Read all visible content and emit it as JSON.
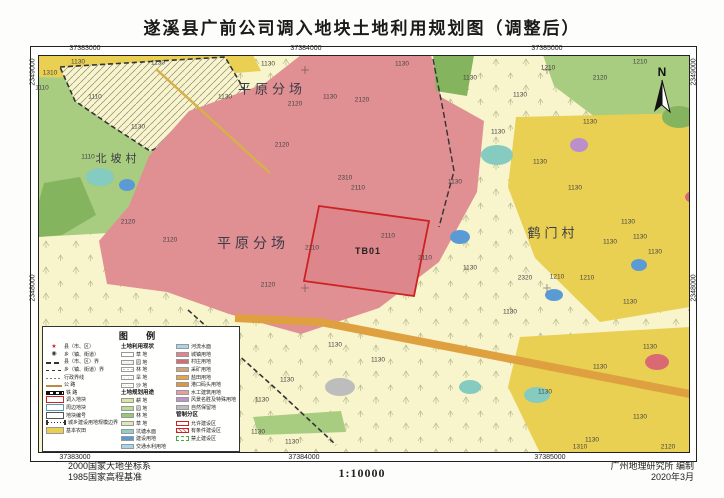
{
  "title": "遂溪县广前公司调入地块土地利用规划图（调整后）",
  "north": {
    "label": "N"
  },
  "footer": {
    "datum1": "2000国家大地坐标系",
    "datum2": "1985国家高程基准",
    "scale": "1:10000",
    "credit1": "广州地理研究所 编制",
    "credit2": "2020年3月"
  },
  "coords": {
    "top": [
      {
        "t": "37383000",
        "x": 85
      },
      {
        "t": "37384000",
        "x": 306
      },
      {
        "t": "37385000",
        "x": 547
      }
    ],
    "bottom": [
      {
        "t": "37383000",
        "x": 75
      },
      {
        "t": "37384000",
        "x": 304
      },
      {
        "t": "37385000",
        "x": 550
      }
    ],
    "left": [
      {
        "t": "2349000",
        "y": 72
      },
      {
        "t": "2348000",
        "y": 288
      }
    ],
    "right": [
      {
        "t": "2349000",
        "y": 72
      },
      {
        "t": "2348000",
        "y": 288
      }
    ]
  },
  "places": [
    {
      "t": "平原分场",
      "x": 272,
      "y": 88,
      "s": 13
    },
    {
      "t": "北坡村",
      "x": 118,
      "y": 158,
      "s": 11
    },
    {
      "t": "平原分场",
      "x": 253,
      "y": 243,
      "s": 14
    },
    {
      "t": "鹤门村",
      "x": 553,
      "y": 232,
      "s": 13
    },
    {
      "t": "TB01",
      "x": 368,
      "y": 251,
      "s": 9,
      "b": 1
    }
  ],
  "codes": [
    {
      "t": "1130",
      "x": 78,
      "y": 62
    },
    {
      "t": "1130",
      "x": 158,
      "y": 63
    },
    {
      "t": "1130",
      "x": 268,
      "y": 64
    },
    {
      "t": "1130",
      "x": 402,
      "y": 64
    },
    {
      "t": "1210",
      "x": 548,
      "y": 68
    },
    {
      "t": "1210",
      "x": 640,
      "y": 62
    },
    {
      "t": "1310",
      "x": 50,
      "y": 73
    },
    {
      "t": "1110",
      "x": 42,
      "y": 88
    },
    {
      "t": "1110",
      "x": 95,
      "y": 97
    },
    {
      "t": "1130",
      "x": 225,
      "y": 97
    },
    {
      "t": "1130",
      "x": 330,
      "y": 97
    },
    {
      "t": "2120",
      "x": 295,
      "y": 104
    },
    {
      "t": "2120",
      "x": 362,
      "y": 100
    },
    {
      "t": "1130",
      "x": 138,
      "y": 127
    },
    {
      "t": "1110",
      "x": 88,
      "y": 157
    },
    {
      "t": "2120",
      "x": 282,
      "y": 145
    },
    {
      "t": "2310",
      "x": 345,
      "y": 178
    },
    {
      "t": "2110",
      "x": 358,
      "y": 188
    },
    {
      "t": "2120",
      "x": 128,
      "y": 222
    },
    {
      "t": "2120",
      "x": 170,
      "y": 240
    },
    {
      "t": "2110",
      "x": 312,
      "y": 248
    },
    {
      "t": "2110",
      "x": 388,
      "y": 236
    },
    {
      "t": "2110",
      "x": 425,
      "y": 258
    },
    {
      "t": "2120",
      "x": 268,
      "y": 285
    },
    {
      "t": "1130",
      "x": 470,
      "y": 78
    },
    {
      "t": "2120",
      "x": 600,
      "y": 78
    },
    {
      "t": "1130",
      "x": 520,
      "y": 95
    },
    {
      "t": "1130",
      "x": 590,
      "y": 122
    },
    {
      "t": "1130",
      "x": 498,
      "y": 132
    },
    {
      "t": "1130",
      "x": 540,
      "y": 162
    },
    {
      "t": "1130",
      "x": 455,
      "y": 182
    },
    {
      "t": "1130",
      "x": 575,
      "y": 188
    },
    {
      "t": "1130",
      "x": 628,
      "y": 222
    },
    {
      "t": "1130",
      "x": 640,
      "y": 237
    },
    {
      "t": "1130",
      "x": 610,
      "y": 242
    },
    {
      "t": "1130",
      "x": 655,
      "y": 252
    },
    {
      "t": "1130",
      "x": 470,
      "y": 268
    },
    {
      "t": "2320",
      "x": 525,
      "y": 278
    },
    {
      "t": "1210",
      "x": 557,
      "y": 277
    },
    {
      "t": "1210",
      "x": 587,
      "y": 278
    },
    {
      "t": "1130",
      "x": 630,
      "y": 302
    },
    {
      "t": "1130",
      "x": 510,
      "y": 312
    },
    {
      "t": "1130",
      "x": 335,
      "y": 345
    },
    {
      "t": "1130",
      "x": 650,
      "y": 347
    },
    {
      "t": "1130",
      "x": 378,
      "y": 360
    },
    {
      "t": "1130",
      "x": 600,
      "y": 367
    },
    {
      "t": "1130",
      "x": 287,
      "y": 380
    },
    {
      "t": "1130",
      "x": 545,
      "y": 392
    },
    {
      "t": "1130",
      "x": 262,
      "y": 400
    },
    {
      "t": "1130",
      "x": 640,
      "y": 417
    },
    {
      "t": "1130",
      "x": 258,
      "y": 432
    },
    {
      "t": "1130",
      "x": 592,
      "y": 440
    },
    {
      "t": "1130",
      "x": 292,
      "y": 442
    },
    {
      "t": "1310",
      "x": 580,
      "y": 447
    },
    {
      "t": "2120",
      "x": 668,
      "y": 447
    }
  ],
  "legend": {
    "title": "图  例",
    "symbols": [
      {
        "sym": "star",
        "glyph": "★",
        "label": "县（市、区）"
      },
      {
        "sym": "town",
        "glyph": "◉",
        "label": "乡（镇、街道）"
      },
      {
        "sym": "county-line",
        "label": "县（市、区）界"
      },
      {
        "sym": "township-line",
        "label": "乡（镇、街道）界"
      },
      {
        "sym": "admin-line",
        "label": "行政界线"
      },
      {
        "sym": "road",
        "label": "公  路"
      },
      {
        "sym": "rail",
        "label": "铁  路"
      },
      {
        "sym": "red-rect",
        "label": "调入地块"
      },
      {
        "sym": "blue-rect",
        "label": "周边地块"
      },
      {
        "sym": "tag",
        "label": "地块编号"
      },
      {
        "sym": "scope",
        "label": "城乡建设用地规模边界"
      },
      {
        "sym": "yellow",
        "label": "基本农田"
      }
    ],
    "status_header": "土地利用现状",
    "status_items": [
      {
        "p": "dots",
        "label": "草 地"
      },
      {
        "p": "circles",
        "label": "园 地"
      },
      {
        "p": "trees",
        "label": "林 地"
      },
      {
        "p": "dots2",
        "label": "旱 地"
      },
      {
        "p": "sand",
        "label": "沙 地"
      }
    ],
    "plan_header": "土地规划用途",
    "plan_items": [
      {
        "c": "#d9e79c",
        "label": "耕 地"
      },
      {
        "c": "#b8dc90",
        "label": "园 地"
      },
      {
        "c": "#93cb72",
        "label": "林 地"
      },
      {
        "c": "#dcebb4",
        "label": "草 地"
      },
      {
        "c": "#8fd0c5",
        "label": "坑塘水面"
      },
      {
        "c": "#5b9bd5",
        "label": "建设用地"
      },
      {
        "c": "#a9d4e9",
        "label": "交通水利用地"
      }
    ],
    "use_items": [
      {
        "c": "#a9d4e9",
        "label": "河流水面"
      },
      {
        "c": "#e2848c",
        "label": "城镇用地"
      },
      {
        "c": "#d96a73",
        "label": "村庄用地"
      },
      {
        "c": "#cfa47e",
        "label": "采矿用地"
      },
      {
        "c": "#e8a44a",
        "label": "盐田用地"
      },
      {
        "c": "#e2953f",
        "label": "港口码头用地"
      },
      {
        "c": "#e89ca4",
        "label": "水工建筑用地"
      },
      {
        "c": "#c490cc",
        "label": "风景名胜及特殊用地"
      },
      {
        "c": "#bdbdbd",
        "label": "自然保留地"
      }
    ],
    "zone_header": "管制分区",
    "zone_items": [
      {
        "p": "allow",
        "label": "允许建设区"
      },
      {
        "p": "cond",
        "label": "有条件建设区"
      },
      {
        "p": "forbid",
        "label": "禁止建设区"
      }
    ]
  },
  "colors": {
    "base": "#f8f4cc",
    "pink": "#e08f93",
    "pink_dark": "#dd868c",
    "yellow": "#e9cf52",
    "green": "#a8cc80",
    "green_dark": "#84b45e",
    "teal": "#85cbc0",
    "blue": "#5b9bd5",
    "orange_road": "#dfa040",
    "purple": "#bb8fcb",
    "red_patch": "#d96a73",
    "gray": "#bdbdbd",
    "border_red": "#cc2222"
  }
}
